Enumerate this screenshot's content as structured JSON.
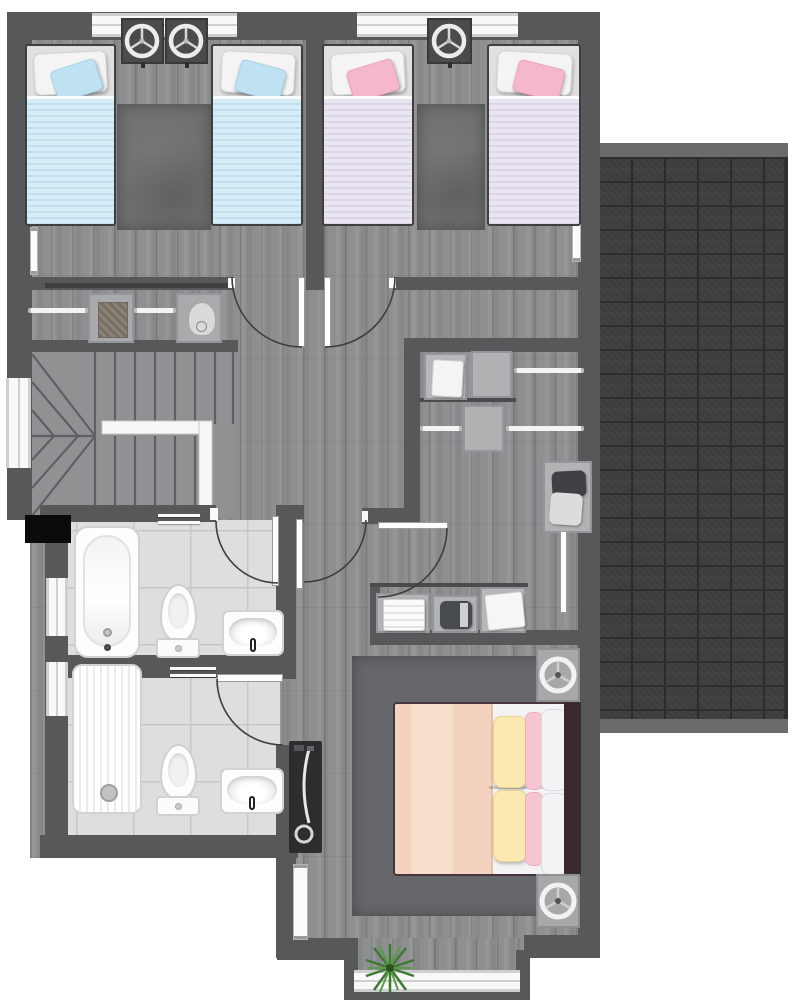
{
  "meta": {
    "type": "floor-plan",
    "view": "top-down",
    "level": "upper-floor"
  },
  "palette": {
    "wall": "#57585a",
    "floor_wood": "#8e8f91",
    "floor_tile": "#dedede",
    "roof_shingle": "#3c3d3f",
    "rug": "#6e6f71",
    "bed_blue": "#cfe8f4",
    "bed_lavender": "#e7e1ee",
    "cushion_blue": "#bfe2f2",
    "cushion_pink": "#f5b8ca",
    "master_blanket_peach": "#f5d7c3",
    "pillow_yellow": "#fce9b0",
    "pillow_pink": "#f6c6d2",
    "headboard_brown": "#3a2930",
    "fixture_white": "#fdfdfd",
    "door_leaf": "#fdfdfd",
    "swing_arc": "#3e3e40",
    "plant_green": "#3e7a31",
    "plant_green_light": "#5a9a4a",
    "void_black": "#0b0b0b"
  },
  "rooms": {
    "kids_bedroom_left": {
      "furniture": [
        "single-bed-blue",
        "single-bed-blue",
        "nightstand-fan",
        "nightstand-fan",
        "rug",
        "radiator"
      ]
    },
    "kids_bedroom_right": {
      "furniture": [
        "single-bed-lavender",
        "single-bed-lavender",
        "nightstand-fan",
        "rug",
        "radiator"
      ]
    },
    "landing": {
      "furniture": [
        "closet-hanging-rod",
        "storage-box-basket",
        "storage-box-heater"
      ]
    },
    "stairwell": {
      "features": [
        "upper-flight",
        "lower-flight",
        "winder-steps",
        "handrail",
        "window",
        "void"
      ]
    },
    "walk_in_closet": {
      "furniture": [
        "shelf-box-towels",
        "shelf-box",
        "shelf-box",
        "hanging-rod",
        "hanging-rod",
        "hanging-rod",
        "laundry-basket"
      ]
    },
    "linen_closet": {
      "furniture": [
        "towel-stack-white",
        "towel-stack-dark",
        "towel-pile-white"
      ]
    },
    "bathroom_top": {
      "fixtures": [
        "bathtub",
        "toilet",
        "sink",
        "towel-rail",
        "window",
        "door"
      ]
    },
    "bathroom_bottom": {
      "fixtures": [
        "shower-tray",
        "toilet",
        "sink",
        "towel-rail",
        "window",
        "door"
      ]
    },
    "master_bedroom": {
      "furniture": [
        "double-bed",
        "nightstand-fan",
        "nightstand-fan",
        "tv-stand",
        "rug",
        "radiator",
        "plant",
        "bay-window"
      ]
    },
    "roof": {
      "feature": "shingle-roof-over-garage"
    }
  },
  "counts": {
    "bedrooms": 3,
    "bathrooms": 2,
    "single_beds": 4,
    "double_beds": 1,
    "fans": 5,
    "interior_doors": 6,
    "windows": 6
  }
}
